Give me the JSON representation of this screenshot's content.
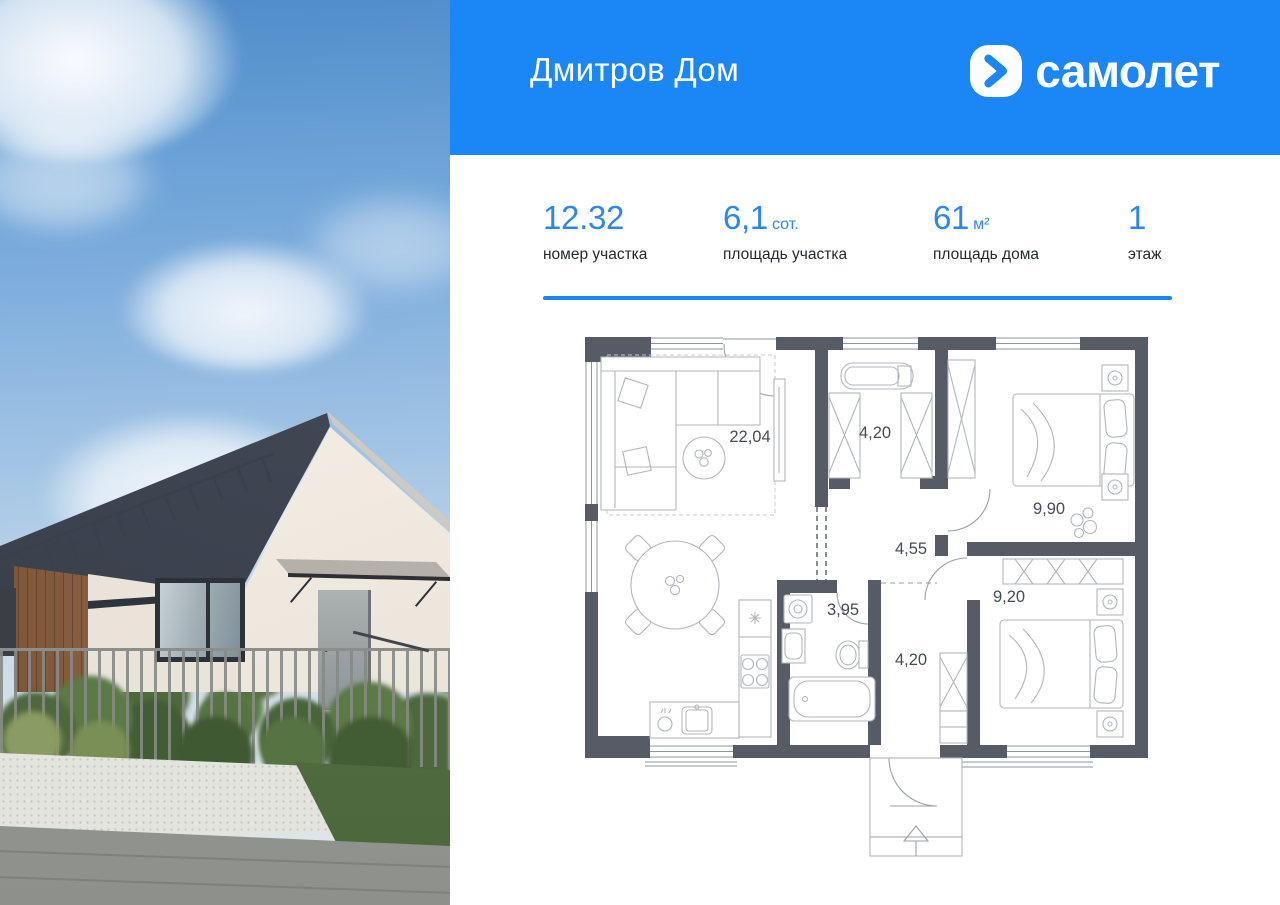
{
  "header": {
    "title": "Дмитров Дом",
    "logo_text": "самолет"
  },
  "stats": [
    {
      "value": "12.32",
      "unit": "",
      "label": "номер участка"
    },
    {
      "value": "6,1",
      "unit": "сот.",
      "label": "площадь участка"
    },
    {
      "value": "61",
      "unit": "м²",
      "label": "площадь дома"
    },
    {
      "value": "1",
      "unit": "",
      "label": "этаж"
    }
  ],
  "floor_plan": {
    "rooms": [
      {
        "key": "living-kitchen",
        "area": "22,04"
      },
      {
        "key": "wardrobe",
        "area": "4,20"
      },
      {
        "key": "bedroom-1",
        "area": "9,90"
      },
      {
        "key": "hallway",
        "area": "4,55"
      },
      {
        "key": "bathroom",
        "area": "3,95"
      },
      {
        "key": "entry-corridor",
        "area": "4,20"
      },
      {
        "key": "bedroom-2",
        "area": "9,20"
      }
    ]
  },
  "colors": {
    "brand_blue": "#1b86f5",
    "accent_blue": "#2b87f0",
    "wall_dark": "#565b66"
  }
}
